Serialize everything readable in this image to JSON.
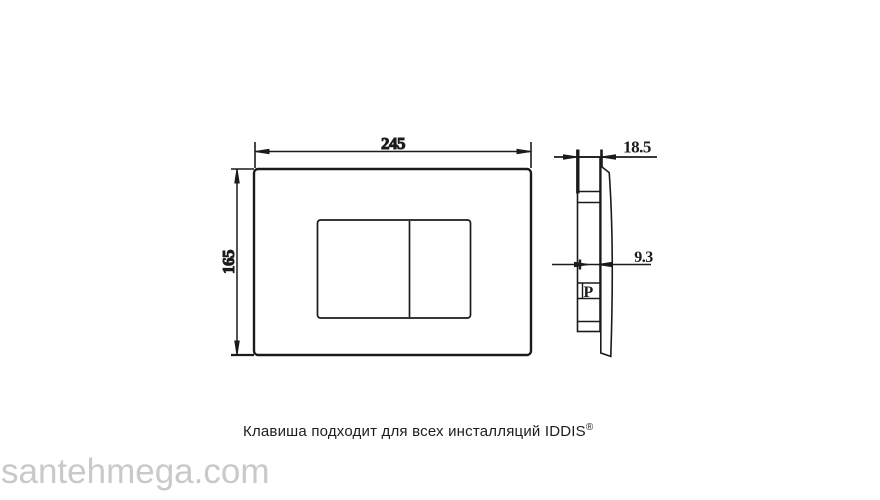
{
  "technical_drawing": {
    "front_view": {
      "width_dim": "245",
      "height_dim": "165"
    },
    "side_view": {
      "depth_dim": "18.5",
      "button_depth_dim": "9.3",
      "port_label": "P"
    },
    "caption": {
      "text": "Клавиша подходит для всех инсталляций IDDIS",
      "trademark": "®"
    }
  },
  "watermark": {
    "text": "santehmega.com"
  },
  "colors": {
    "line": "#1b1b1b",
    "caption_text": "#1d1d1d",
    "watermark": "#c9c9c9",
    "background": "#ffffff"
  }
}
